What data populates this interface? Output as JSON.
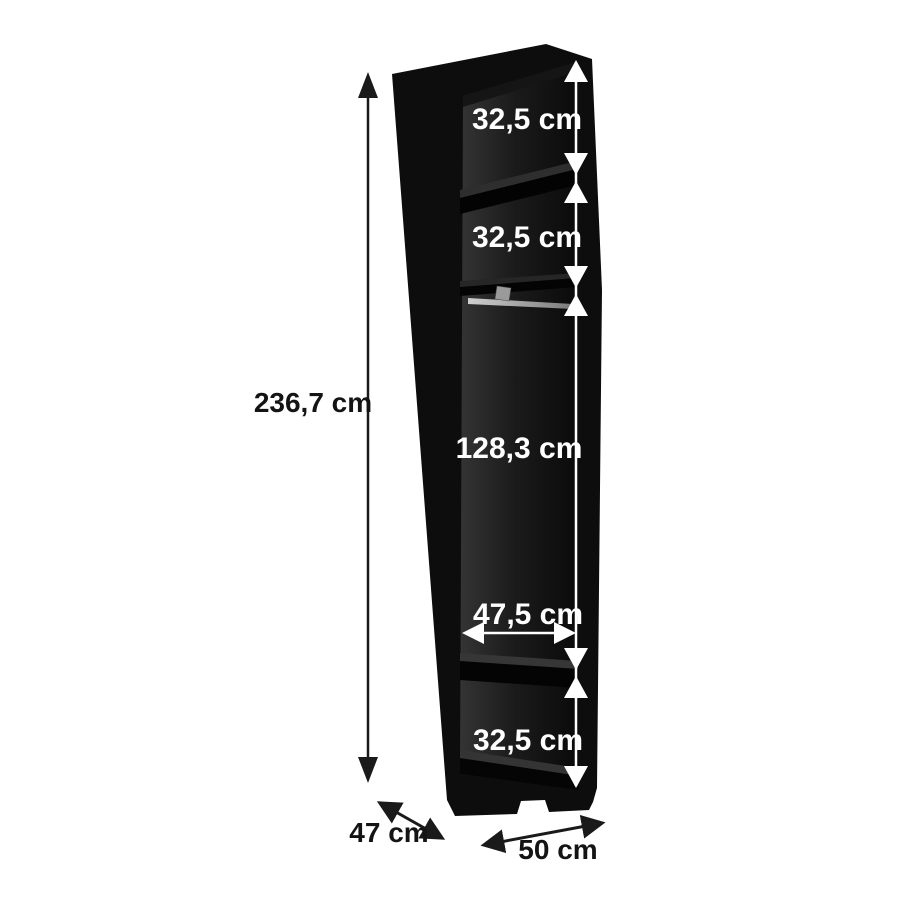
{
  "measurements": {
    "top_section": "32,5 cm",
    "second_section": "32,5 cm",
    "hanging_section": "128,3 cm",
    "interior_width": "47,5 cm",
    "bottom_section": "32,5 cm",
    "total_height": "236,7 cm",
    "depth": "47 cm",
    "width": "50 cm"
  },
  "colors": {
    "background": "#ffffff",
    "cabinet_black": "#0d0d0d",
    "dimension_light": "#ffffff",
    "dimension_dark": "#1a1a1a"
  }
}
